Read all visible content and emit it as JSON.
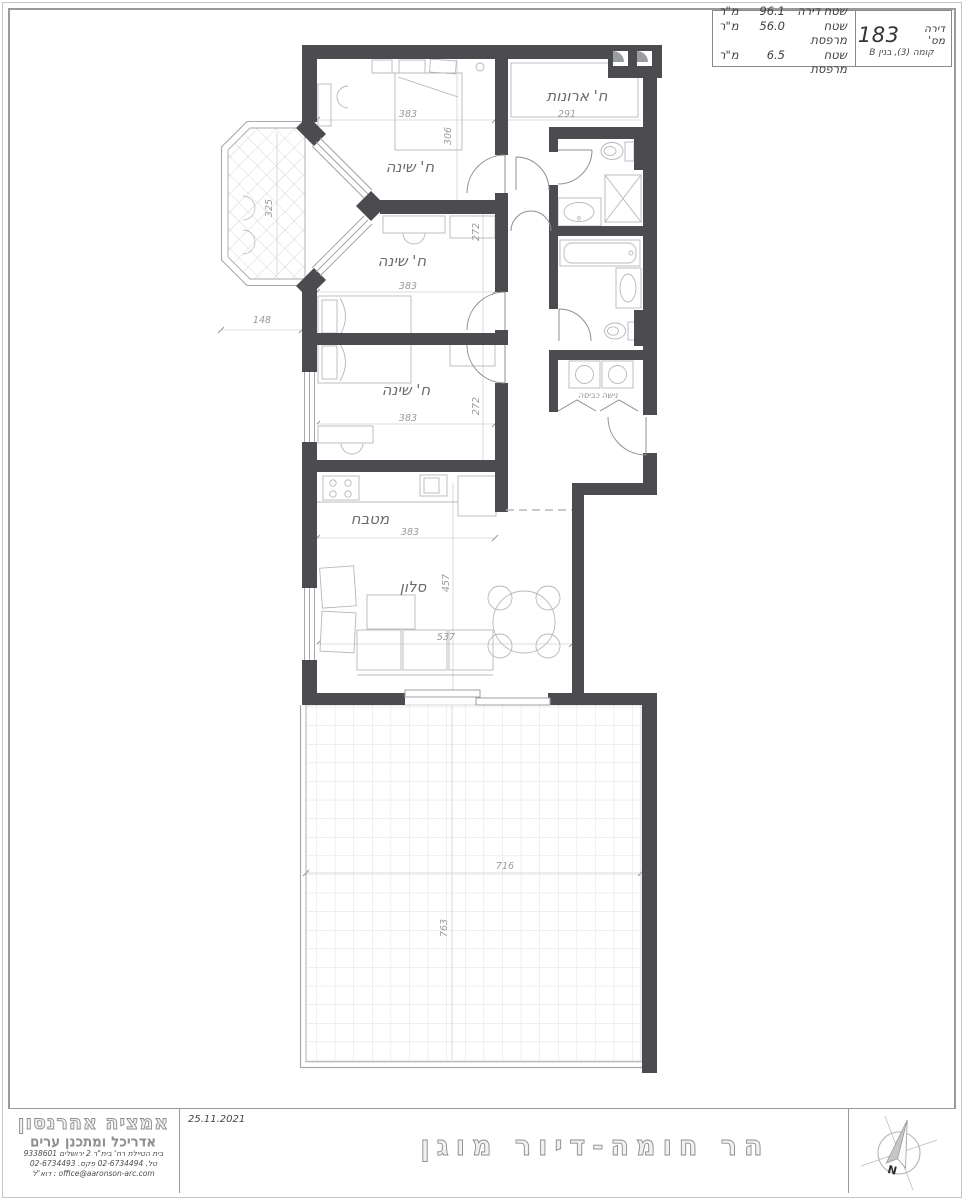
{
  "info_box": {
    "apartment_label": "דירה מס'",
    "apartment_number": "183",
    "floor_line": "קומה (3), בנין B",
    "rows": [
      {
        "label": "שטח דירה",
        "value": "96.1",
        "unit": "מ\"ר"
      },
      {
        "label": "שטח מרפסת",
        "value": "56.0",
        "unit": "מ\"ר"
      },
      {
        "label": "שטח מרפסת",
        "value": "6.5",
        "unit": "מ\"ר"
      }
    ]
  },
  "plan": {
    "bedroom1": {
      "label": "ח' שינה",
      "width": "383",
      "height": "306"
    },
    "closet_room": {
      "label": "ח' ארונות",
      "width": "291"
    },
    "bedroom2": {
      "label": "ח' שינה",
      "width": "383",
      "height": "272"
    },
    "bedroom3": {
      "label": "ח' שינה",
      "width": "383",
      "height": "272"
    },
    "kitchen": {
      "label": "מטבח",
      "width": "383"
    },
    "living": {
      "label": "סלון",
      "width": "537",
      "height": "457"
    },
    "laundry": {
      "label": "נישה כביסה"
    },
    "balcony": {
      "height": "325",
      "width": "148"
    },
    "terrace": {
      "width": "716",
      "height": "763"
    }
  },
  "title_block": {
    "date": "25.11.2021",
    "project_title": "הר חומה-דיור מוגן",
    "firm_name": "אמציה אהרנסון",
    "firm_role": "אדריכל ומתכנן ערים",
    "firm_address": "בית הטיילת רח' בית\"ר 2 ירושלים 9338601",
    "firm_phone": "טל. 02-6734494 פקס. 02-6734493",
    "firm_email": "office@aaronson-arc.com : דוא\"ל",
    "north_label": "N"
  },
  "colors": {
    "wall": "#4c4c50",
    "thin_line": "#a8acb0",
    "furniture_line": "#b4b8bc",
    "dim_text": "#9b9b9b",
    "label_text": "#6b6b6b",
    "grid": "#dcdfe2",
    "border": "#9a9a9a"
  }
}
